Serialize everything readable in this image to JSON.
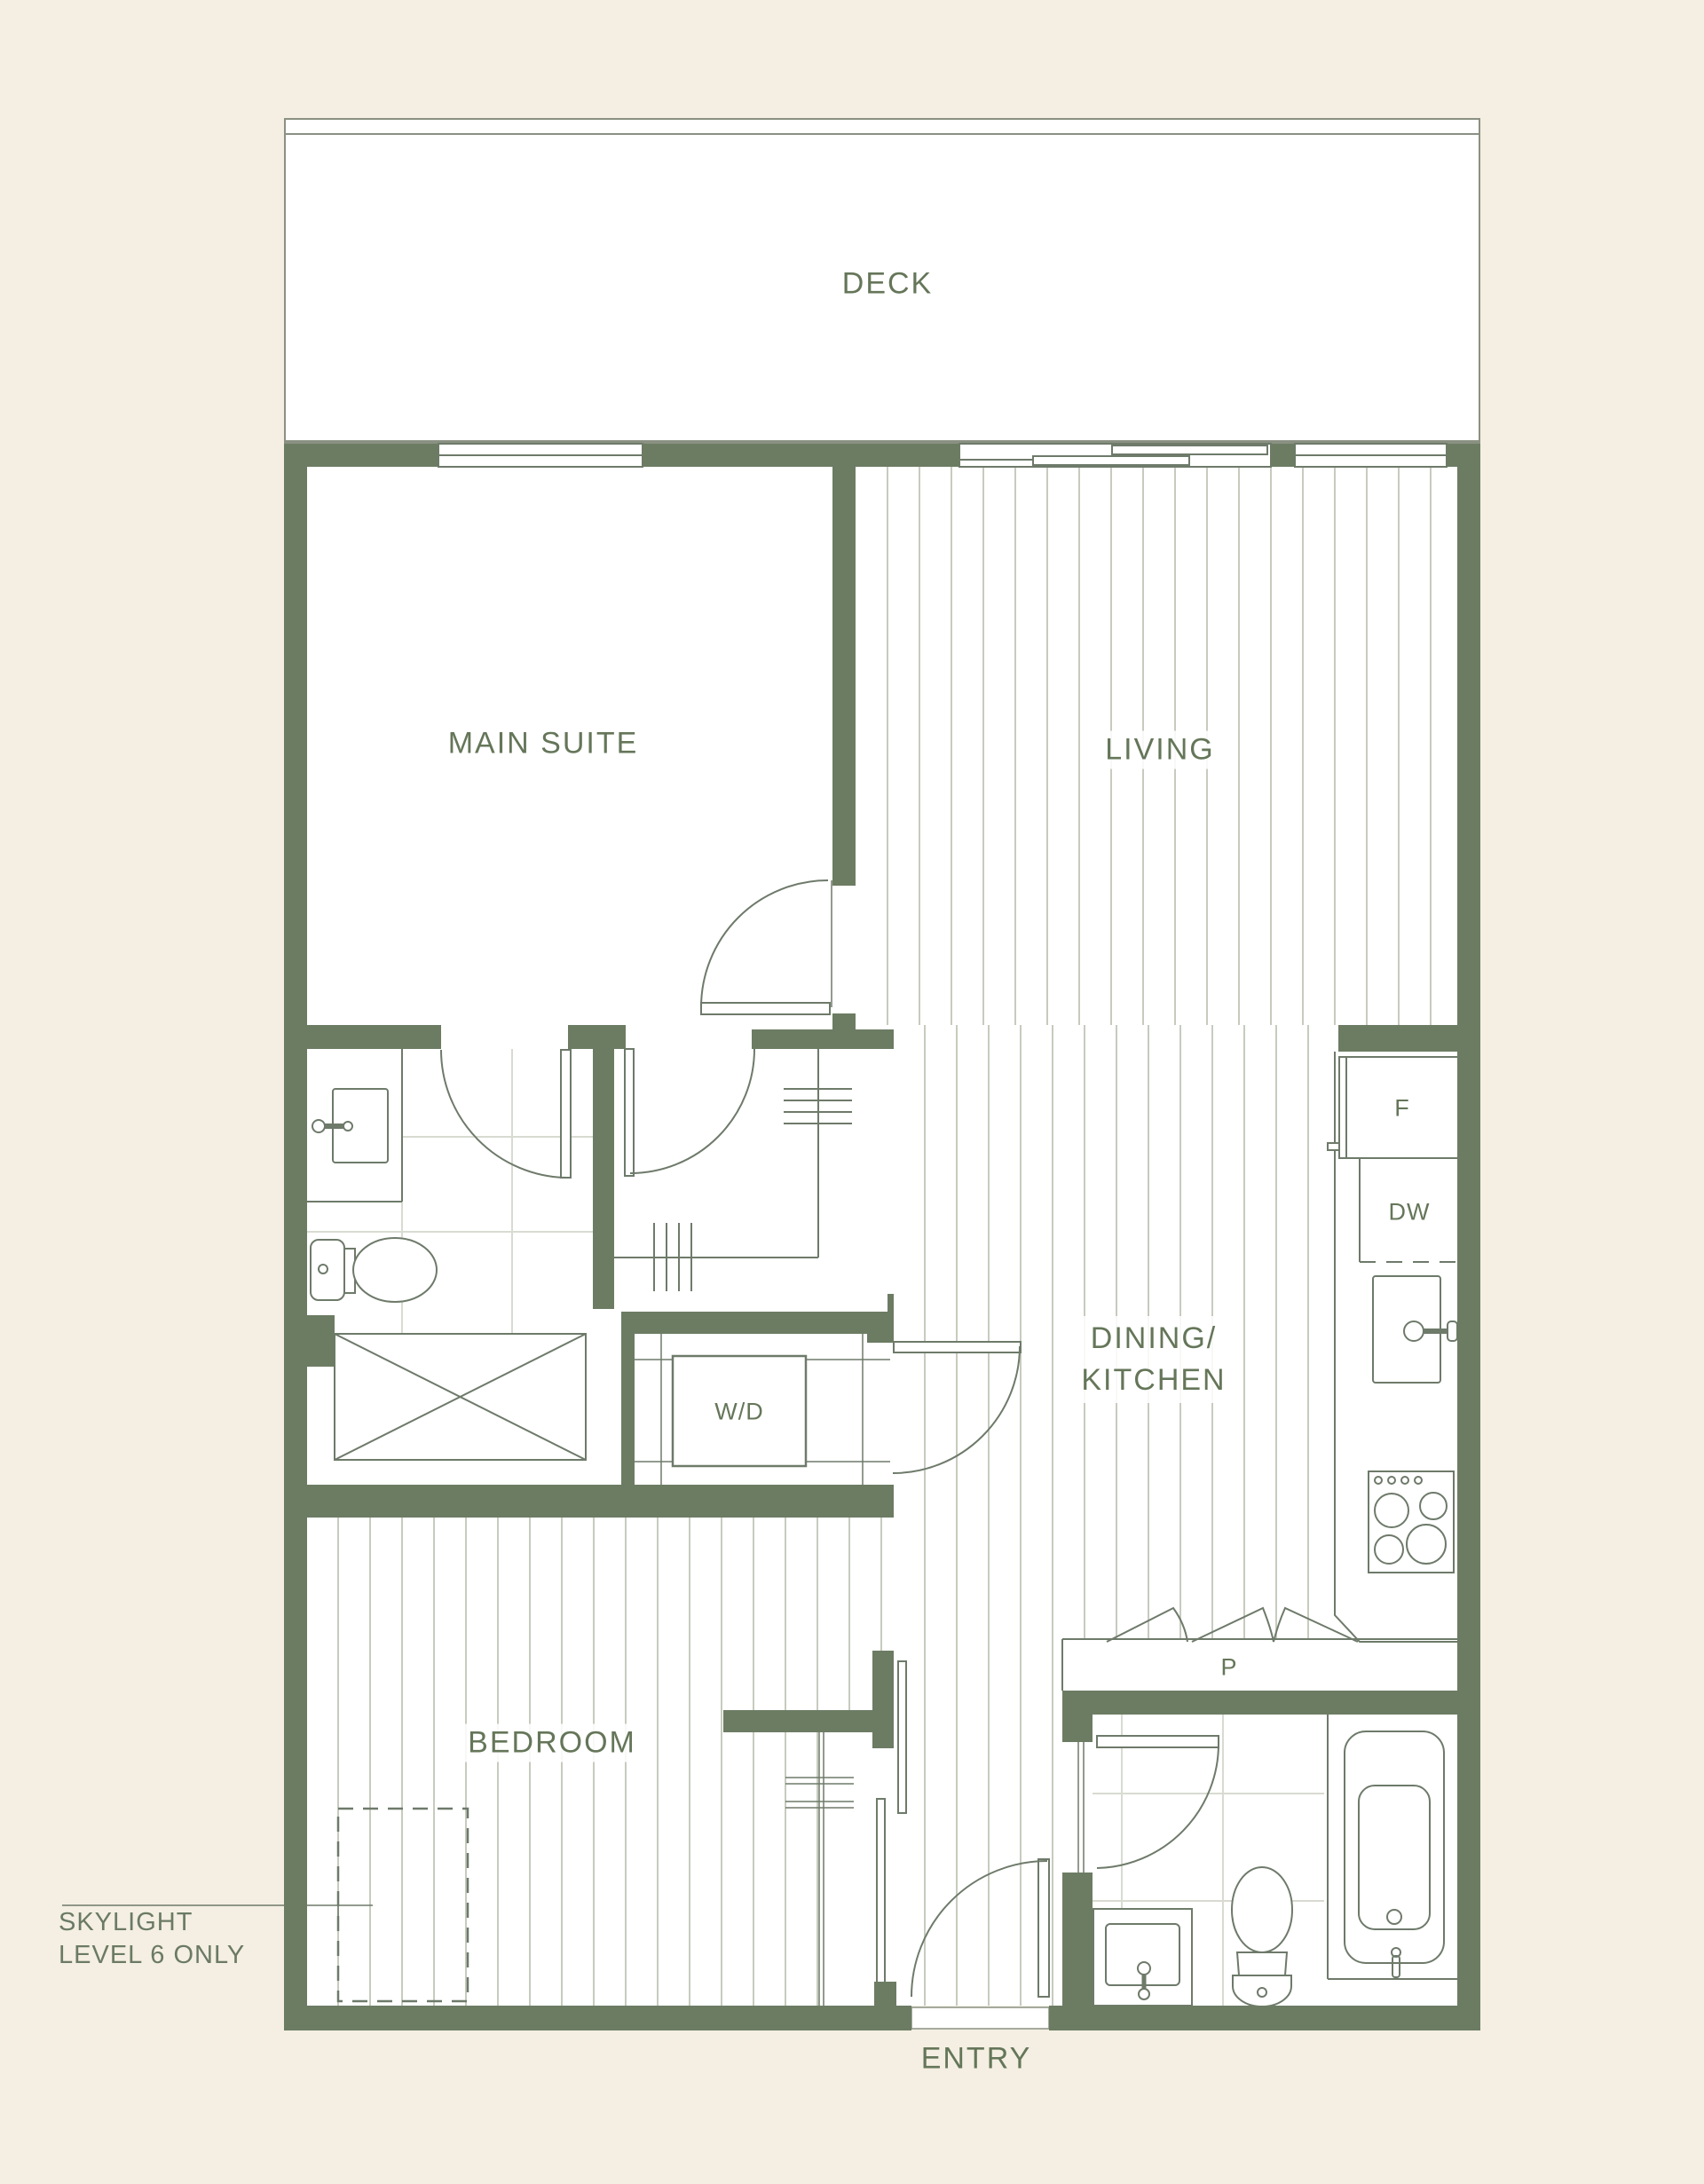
{
  "plan": {
    "type": "residential floor plan",
    "labels": {
      "deck": "DECK",
      "main_suite": "MAIN SUITE",
      "living": "LIVING",
      "dining_kitchen_line1": "DINING/",
      "dining_kitchen_line2": "KITCHEN",
      "bedroom": "BEDROOM",
      "entry": "ENTRY",
      "fridge": "F",
      "dishwasher": "DW",
      "washer_dryer": "W/D",
      "pantry": "P",
      "skylight_line1": "SKYLIGHT",
      "skylight_line2": "LEVEL 6 ONLY"
    },
    "rooms": [
      {
        "id": "deck",
        "label": "DECK"
      },
      {
        "id": "main_suite",
        "label": "MAIN SUITE"
      },
      {
        "id": "living",
        "label": "LIVING"
      },
      {
        "id": "dining_kitchen",
        "label": "DINING/KITCHEN"
      },
      {
        "id": "bedroom",
        "label": "BEDROOM"
      },
      {
        "id": "entry",
        "label": "ENTRY"
      },
      {
        "id": "ensuite_bathroom",
        "label": ""
      },
      {
        "id": "second_bathroom",
        "label": ""
      },
      {
        "id": "walk_in_closet",
        "label": ""
      }
    ],
    "appliances": [
      {
        "id": "fridge",
        "label": "F"
      },
      {
        "id": "dishwasher",
        "label": "DW"
      },
      {
        "id": "washer_dryer",
        "label": "W/D"
      },
      {
        "id": "pantry",
        "label": "P"
      }
    ],
    "annotations": [
      {
        "id": "skylight_note",
        "lines": [
          "SKYLIGHT",
          "LEVEL 6 ONLY"
        ],
        "target": "dashed skylight outline in bedroom"
      }
    ],
    "colors": {
      "background": "#f4efe2",
      "wall": "#6c7c63",
      "fixture_line": "#6e7a6a",
      "deck_outline": "#8a9183",
      "plank_line": "#c7cbbe",
      "tile_line": "#d8dbd1",
      "label_text": "#657659"
    }
  }
}
